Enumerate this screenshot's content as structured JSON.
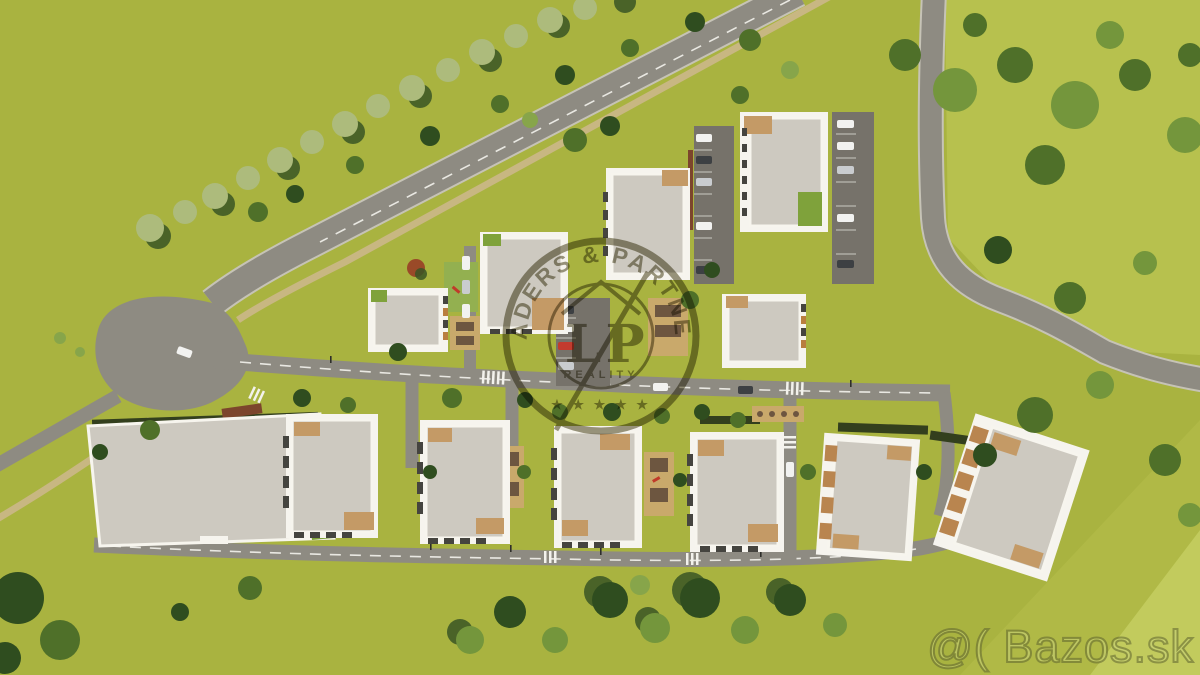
{
  "watermark_logo": {
    "arc_text": "LEADERS & PARTNERS",
    "monogram_left": "L",
    "monogram_right": "P",
    "subtext": "REALITY",
    "stars": "★ ★ ★ ★ ★"
  },
  "site_watermark": {
    "text": "@( Bazos.sk"
  },
  "colors": {
    "grass": "#a9b340",
    "grass_light": "#b7c14e",
    "grass_bright": "#c2cb5d",
    "road": "#8e8b82",
    "road_edge": "#c6c3b6",
    "asphalt": "#76726a",
    "path": "#c8b782",
    "building": "#f6f4ee",
    "roof": "#cdc9c0",
    "roof_warm": "#c49a66",
    "tree_dark": "#3a5524",
    "tree_mid": "#4f7029",
    "tree_light": "#74963c",
    "tree_pale": "#adbb7c",
    "green_roof": "#7fa23b",
    "hedge": "#333f1d",
    "logo": "#40390f",
    "bazos_fill": "#c9d17b",
    "bazos_stroke": "#5f6430"
  }
}
